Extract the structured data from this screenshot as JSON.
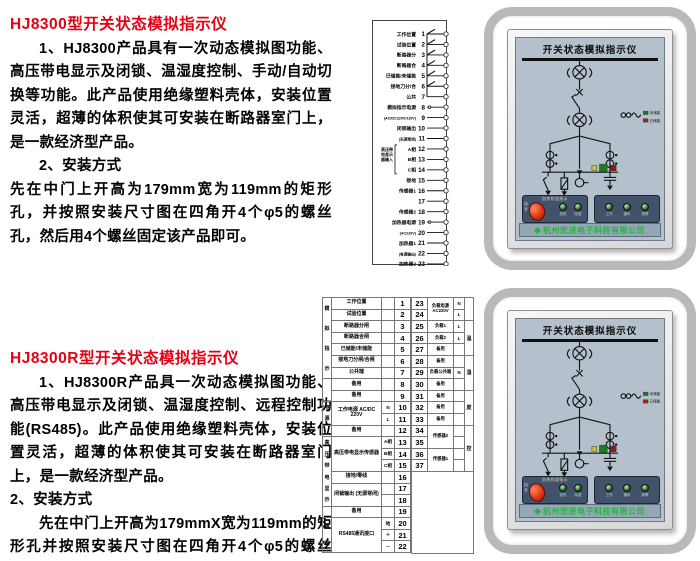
{
  "colors": {
    "heading_red": "#e60014",
    "brand_green": "#28b440",
    "panel_blue": "#b4c1cc"
  },
  "section1": {
    "title": "HJ8300型开关状态模拟指示仪",
    "p1": "1、HJ8300产品具有一次动态模拟图功能、高压带电显示及闭锁、温湿度控制、手动/自动切换等功能。此产品使用绝缘塑料壳体，安装位置灵活，超薄的体积使其可安装在断路器室门上，是一款经济型产品。",
    "p2": "2、安装方式",
    "p3": "先在中门上开高为179mm宽为119mm的矩形孔，并按照安装尺寸图在四角开4个φ5的螺丝孔，然后用4个螺丝固定该产品即可。"
  },
  "section2": {
    "title": "HJ8300R型开关状态模拟指示仪",
    "p1": "1、HJ8300R产品具一次动态模拟图功能、高压带电显示及闭锁、温湿度控制、远程控制功能(RS485)。此产品使用绝缘塑料壳体，安装位置灵活，超薄的体积使其可安装在断路器室门上，是一款经济型产品。",
    "p2": "2、安装方式",
    "p3": "先在中门上开高为179mmX宽为119mm的矩形孔并按照安装尺寸图在四角开4个φ5的螺丝孔，然后用4个螺丝固定该产品即可。"
  },
  "terminal_diagram": {
    "rows": [
      {
        "n": "1",
        "label": "工作位置",
        "sw": true
      },
      {
        "n": "2",
        "label": "试验位置",
        "sw": true
      },
      {
        "n": "3",
        "label": "断路器分",
        "sw": true
      },
      {
        "n": "4",
        "label": "断路器合",
        "sw": true
      },
      {
        "n": "5",
        "label": "已储能/未储能",
        "sw": true
      },
      {
        "n": "6",
        "label": "接地刀分/合",
        "sw": true
      },
      {
        "n": "7",
        "label": "公共"
      },
      {
        "n": "8",
        "label": "模拟指示电源",
        "dot": true
      },
      {
        "n": "9",
        "label": "(AC/DC220V/110V)",
        "small": true
      },
      {
        "n": "10",
        "label": "闭锁输出"
      },
      {
        "n": "11",
        "label": "(无源常闭)",
        "small": true
      },
      {
        "n": "12",
        "label": "A相"
      },
      {
        "n": "13",
        "label": "B相"
      },
      {
        "n": "14",
        "label": "C相"
      },
      {
        "n": "15",
        "label": "接地"
      },
      {
        "n": "16",
        "label": "传感器1"
      },
      {
        "n": "17",
        "label": ""
      },
      {
        "n": "18",
        "label": "传感器2"
      },
      {
        "n": "19",
        "label": "加热器电源",
        "dot": true
      },
      {
        "n": "20",
        "label": "(AC220V)",
        "small": true
      },
      {
        "n": "21",
        "label": "加热器1"
      },
      {
        "n": "22",
        "label": "(有源输出)",
        "small": true
      },
      {
        "n": "23",
        "label": "加热器2"
      }
    ],
    "bracket_label": [
      "高压带",
      "电显示",
      "器输入"
    ]
  },
  "install_table": {
    "left": {
      "widths": [
        9,
        50,
        13,
        16
      ],
      "nums": [
        "1",
        "2",
        "3",
        "4",
        "5",
        "6",
        "7",
        "8",
        "9",
        "10",
        "11",
        "12",
        "13",
        "14",
        "15",
        "16",
        "17",
        "18",
        "19",
        "20",
        "21",
        "22"
      ],
      "subs": [
        "",
        "",
        "",
        "",
        "",
        "",
        "",
        "",
        "",
        "N",
        "L",
        "",
        "A相",
        "B相",
        "C相",
        "",
        "",
        "",
        "",
        "地",
        "＋",
        "－"
      ],
      "labels": [
        {
          "text": "工作位置",
          "span": 1
        },
        {
          "text": "试验位置",
          "span": 1
        },
        {
          "text": "断路器分闸",
          "span": 1
        },
        {
          "text": "断路器合闸",
          "span": 1
        },
        {
          "text": "已储能/未储能",
          "span": 1
        },
        {
          "text": "接地刀分闸/合闸",
          "span": 1
        },
        {
          "text": "公共端",
          "span": 1
        },
        {
          "text": "备用",
          "span": 1
        },
        {
          "text": "备用",
          "span": 1
        },
        {
          "text": "工作电源 AC/DC 220V",
          "span": 2
        },
        {
          "text": "备用",
          "span": 1
        },
        {
          "text": "高压带电显示传感器",
          "span": 3
        },
        {
          "text": "接地/零线",
          "span": 1
        },
        {
          "text": "闭锁输出 (无源常闭)",
          "span": 2
        },
        {
          "text": "备用",
          "span": 1
        },
        {
          "text": "RS485通讯接口",
          "span": 3
        }
      ],
      "spines": [
        {
          "text": "模拟指示",
          "span": 7
        },
        {
          "text": "",
          "span": 2
        },
        {
          "text": "电源",
          "span": 2
        },
        {
          "text": "",
          "span": 1
        },
        {
          "text": "高压带电显示",
          "span": 6
        },
        {
          "text": "",
          "span": 1
        },
        {
          "text": "通讯",
          "span": 3
        }
      ]
    },
    "right": {
      "widths": [
        16,
        26,
        11,
        9
      ],
      "nums": [
        "23",
        "24",
        "25",
        "26",
        "27",
        "28",
        "29",
        "30",
        "31",
        "32",
        "33",
        "34",
        "35",
        "36",
        "37"
      ],
      "subs": [
        "N",
        "L",
        "L",
        "L",
        "",
        "",
        "N",
        "",
        "",
        "",
        "",
        "",
        "",
        "",
        ""
      ],
      "labels": [
        {
          "text": "负载电源AC220V",
          "span": 2
        },
        {
          "text": "负载1",
          "span": 1
        },
        {
          "text": "负载2",
          "span": 1
        },
        {
          "text": "备用",
          "span": 1
        },
        {
          "text": "备用",
          "span": 1
        },
        {
          "text": "负载公共端",
          "span": 1
        },
        {
          "text": "备用",
          "span": 1
        },
        {
          "text": "备用",
          "span": 1
        },
        {
          "text": "备用",
          "span": 1
        },
        {
          "text": "备用",
          "span": 1
        },
        {
          "text": "传感器2",
          "span": 2
        },
        {
          "text": "传感器1",
          "span": 2
        }
      ],
      "spines": [
        {
          "text": "",
          "span": 2
        },
        {
          "text": "温",
          "span": 3
        },
        {
          "text": "湿",
          "span": 3
        },
        {
          "text": "度",
          "span": 3
        },
        {
          "text": "控",
          "span": 4
        }
      ]
    }
  },
  "photos": {
    "title": "开关状态模拟指示仪",
    "footer": "杭州宏进电子科技有限公司",
    "legend": {
      "uncharged": "未储能",
      "charged": "已储能"
    },
    "left_cluster": {
      "header": "加热除湿指示",
      "knob_top": "自",
      "knob_bottom": "手",
      "leds": [
        "加热",
        "除湿"
      ]
    },
    "right_cluster": {
      "leds": [
        "工作",
        "通讯",
        "故障"
      ]
    }
  }
}
